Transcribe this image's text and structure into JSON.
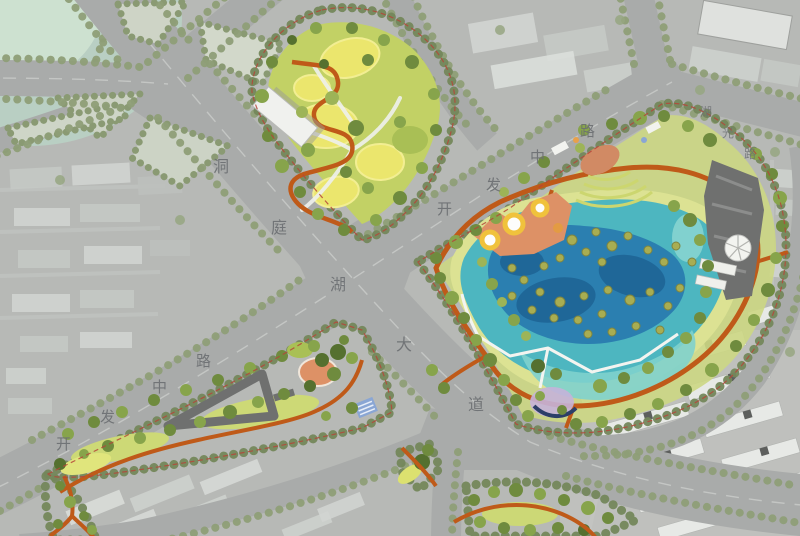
{
  "map": {
    "roads": {
      "dongting_lake_avenue": {
        "name": "洞庭湖大道",
        "chars": [
          "洞",
          "庭",
          "湖",
          "大",
          "道"
        ]
      },
      "kaifa_middle_road_sw": {
        "name": "开发中路",
        "chars": [
          "开",
          "发",
          "中",
          "路"
        ]
      },
      "kaifa_middle_road_ne": {
        "name": "开发中路",
        "chars": [
          "开",
          "发",
          "中",
          "路"
        ]
      },
      "huguang_road": {
        "name": "湖光路",
        "chars": [
          "湖",
          "光",
          "路"
        ]
      }
    },
    "colors": {
      "road_gray": "#a9abaa",
      "urban_base": "#b7b9b6",
      "label_gray": "#6c6f72",
      "tree_row_olive": "#8e9e77",
      "park_dark_green": "#5f7a35",
      "park_green": "#95ad53",
      "meadow_light": "#c6d36a",
      "mound_yellow": "#ebe66d",
      "shore_yellow_green": "#dce293",
      "lake_turquoise": "#4db6c0",
      "lake_deep_blue": "#2b7fb0",
      "lake_navy": "#1d6394",
      "lake_light": "#7fd2cd",
      "path_orange": "#bf5a19",
      "plaza_salmon": "#dd9166",
      "play_ring_yellow": "#f0c23c",
      "parking_dark_gray": "#6f706f",
      "boardwalk_white": "#f3f4f0",
      "boundary_red": "#b5453a",
      "mist_teal": "#b9d2c4",
      "lavender_garden": "#c5b3d9",
      "blue_canopy": "#8aa6d4"
    }
  }
}
